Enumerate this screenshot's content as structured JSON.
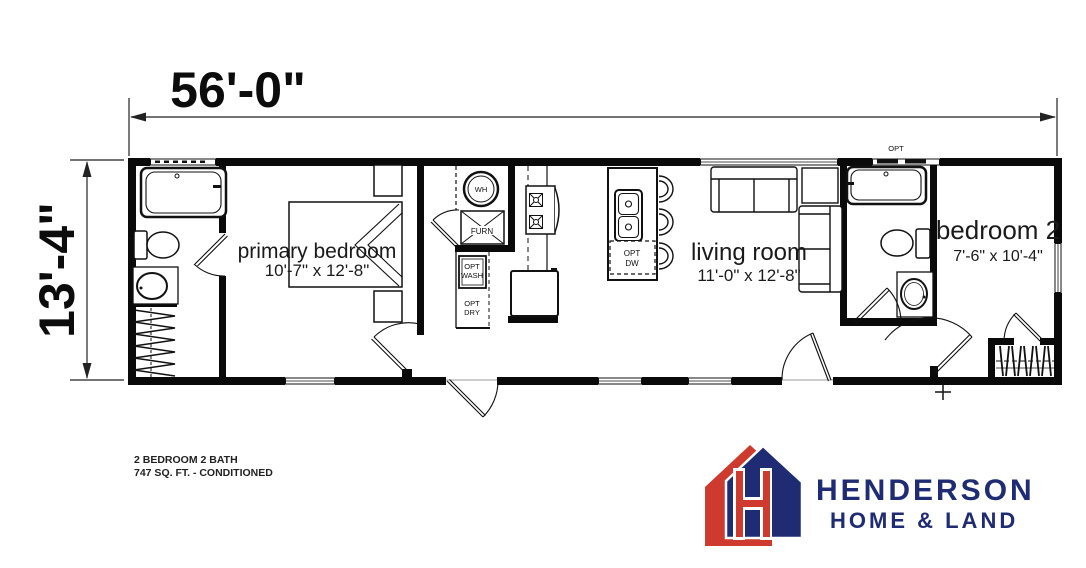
{
  "plan": {
    "width_label": "56'-0\"",
    "height_label": "13'-4\"",
    "rooms": {
      "primary_bedroom": {
        "name": "primary bedroom",
        "size": "10'-7\" x 12'-8\""
      },
      "living_room": {
        "name": "living room",
        "size": "11'-0\" x 12'-8\""
      },
      "bedroom_2": {
        "name": "bedroom 2",
        "size": "7'-6\" x 10'-4\""
      }
    },
    "fixtures": {
      "water_heater": "WH",
      "furnace": "FURN",
      "opt_wash_1": "OPT",
      "opt_wash_2": "WASH",
      "opt_dry_1": "OPT",
      "opt_dry_2": "DRY",
      "opt_dw_1": "OPT",
      "opt_dw_2": "DW",
      "opt_window": "OPT"
    },
    "footer": {
      "line1": "2 BEDROOM 2 BATH",
      "line2": "747 SQ. FT. - CONDITIONED"
    }
  },
  "branding": {
    "name": "HENDERSON",
    "tagline": "HOME & LAND",
    "colors": {
      "red": "#CE3A2D",
      "navy": "#1F2B72"
    }
  }
}
